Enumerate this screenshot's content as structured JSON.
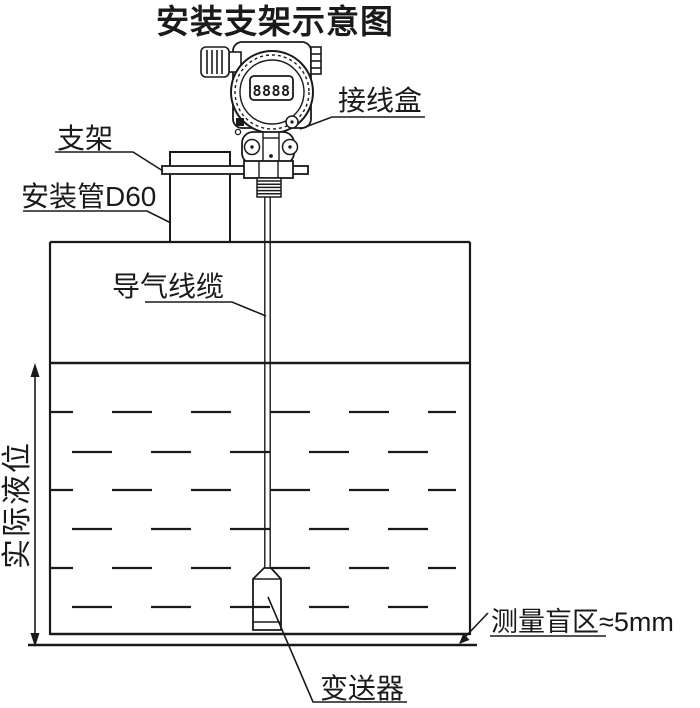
{
  "title": "安装支架示意图",
  "device": {
    "display_value": "8888"
  },
  "labels": {
    "junction_box": "接线盒",
    "bracket": "支架",
    "mounting_pipe": "安装管D60",
    "air_cable": "导气线缆",
    "actual_level": "实际液位",
    "transmitter": "变送器",
    "blind_zone": "测量盲区≈5mm"
  },
  "colors": {
    "line": "#1a1a1a",
    "background": "#ffffff"
  }
}
